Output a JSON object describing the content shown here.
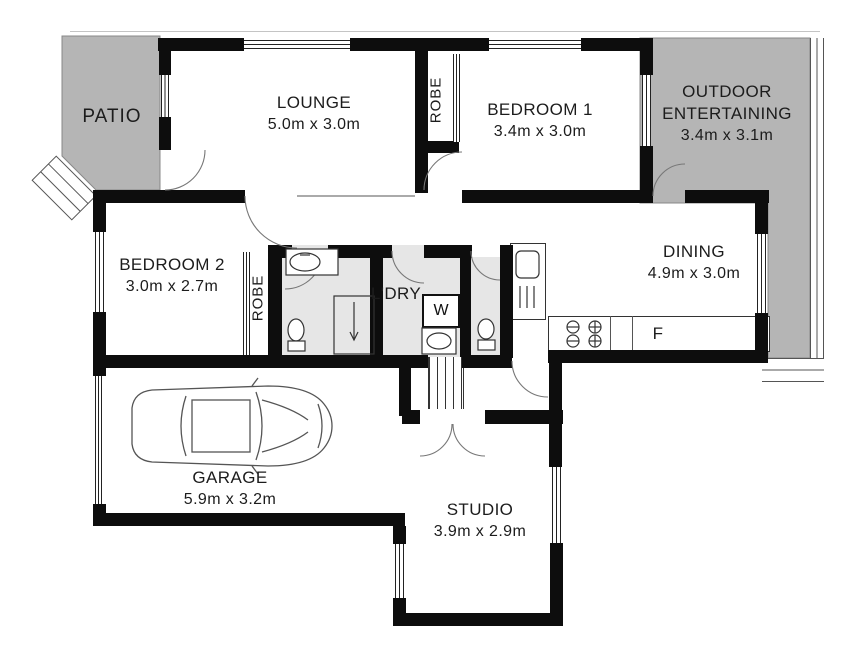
{
  "plan_title": "Residential floor plan",
  "colors": {
    "wall": "#0d0d0d",
    "outdoor_fill": "#b5b5b5",
    "wet_area_fill": "#e6e6e6",
    "door_arc": "#666666"
  },
  "rooms": {
    "patio": {
      "name": "PATIO"
    },
    "lounge": {
      "name": "LOUNGE",
      "dims": "5.0m x 3.0m"
    },
    "robe_top": {
      "name": "ROBE"
    },
    "bedroom1": {
      "name": "BEDROOM 1",
      "dims": "3.4m x 3.0m"
    },
    "outdoor": {
      "line1": "OUTDOOR",
      "line2": "ENTERTAINING",
      "dims": "3.4m x 3.1m"
    },
    "bedroom2": {
      "name": "BEDROOM 2",
      "dims": "3.0m x 2.7m"
    },
    "robe_lower": {
      "name": "ROBE"
    },
    "laundry": {
      "name": "L'DRY"
    },
    "dining": {
      "name": "DINING",
      "dims": "4.9m x 3.0m"
    },
    "garage": {
      "name": "GARAGE",
      "dims": "5.9m x 3.2m"
    },
    "studio": {
      "name": "STUDIO",
      "dims": "3.9m x 2.9m"
    }
  },
  "fixtures": {
    "washer": "W",
    "fridge": "F"
  }
}
